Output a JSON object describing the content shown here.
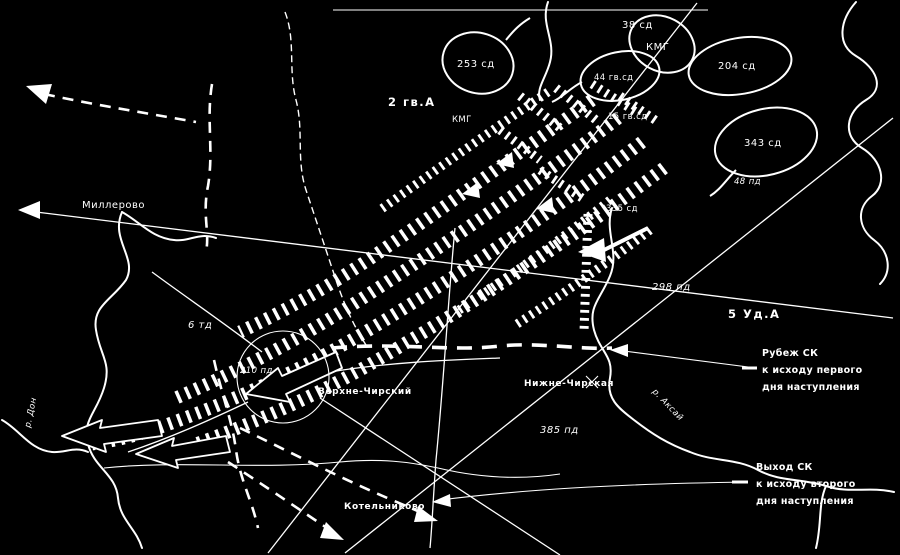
{
  "colors": {
    "background": "#000000",
    "ink": "#ffffff"
  },
  "labels": [
    {
      "id": "army-left",
      "text": "2 гв.А"
    },
    {
      "id": "oval-253sd",
      "text": "253 сд"
    },
    {
      "id": "div-38sd",
      "text": "38 сд"
    },
    {
      "id": "oval-kmg",
      "text": "КМГ"
    },
    {
      "id": "oval-44gvsd",
      "text": "44 гв.сд"
    },
    {
      "id": "oval-204sd",
      "text": "204 сд"
    },
    {
      "id": "oval-343sd",
      "text": "343 сд"
    },
    {
      "id": "div-48pd",
      "text": "48 пд"
    },
    {
      "id": "div-15gvsd",
      "text": "15 гв.сд"
    },
    {
      "id": "kmg-center",
      "text": "КМГ"
    },
    {
      "id": "town-millerovo",
      "text": "Миллерово"
    },
    {
      "id": "div-6td",
      "text": "6 тд"
    },
    {
      "id": "div-210pd",
      "text": "210 пд"
    },
    {
      "id": "town-verhne",
      "text": "Верхне-Чирский"
    },
    {
      "id": "town-nizhne",
      "text": "Нижне-Чирская"
    },
    {
      "id": "div-385pd",
      "text": "385 пд"
    },
    {
      "id": "div-298pd",
      "text": "298 пд"
    },
    {
      "id": "army-right",
      "text": "5 Уд.А"
    },
    {
      "id": "div-335sd",
      "text": "335 сд"
    },
    {
      "id": "river-don",
      "text": "р. Дон"
    },
    {
      "id": "river-aksay",
      "text": "р. Аксай"
    },
    {
      "id": "town-kotelnikovo",
      "text": "Котельниково"
    }
  ],
  "callouts": [
    {
      "lines": [
        "Рубеж СК",
        "к исходу первого",
        "дня наступления"
      ]
    },
    {
      "lines": [
        "Выход СК",
        "к исходу второго",
        "дня наступления"
      ]
    }
  ],
  "icons": [
    {
      "id": "assault-band",
      "meaning": "hatched offensive thrust arrows (NE to SW)"
    },
    {
      "id": "block-arrow",
      "meaning": "outlined attack arrows pointing southwest"
    },
    {
      "id": "front-line",
      "meaning": "dashed front/defense lines"
    },
    {
      "id": "unit-oval",
      "meaning": "unit concentration areas"
    },
    {
      "id": "town-circle",
      "meaning": "encircled town with radiating roads"
    }
  ]
}
